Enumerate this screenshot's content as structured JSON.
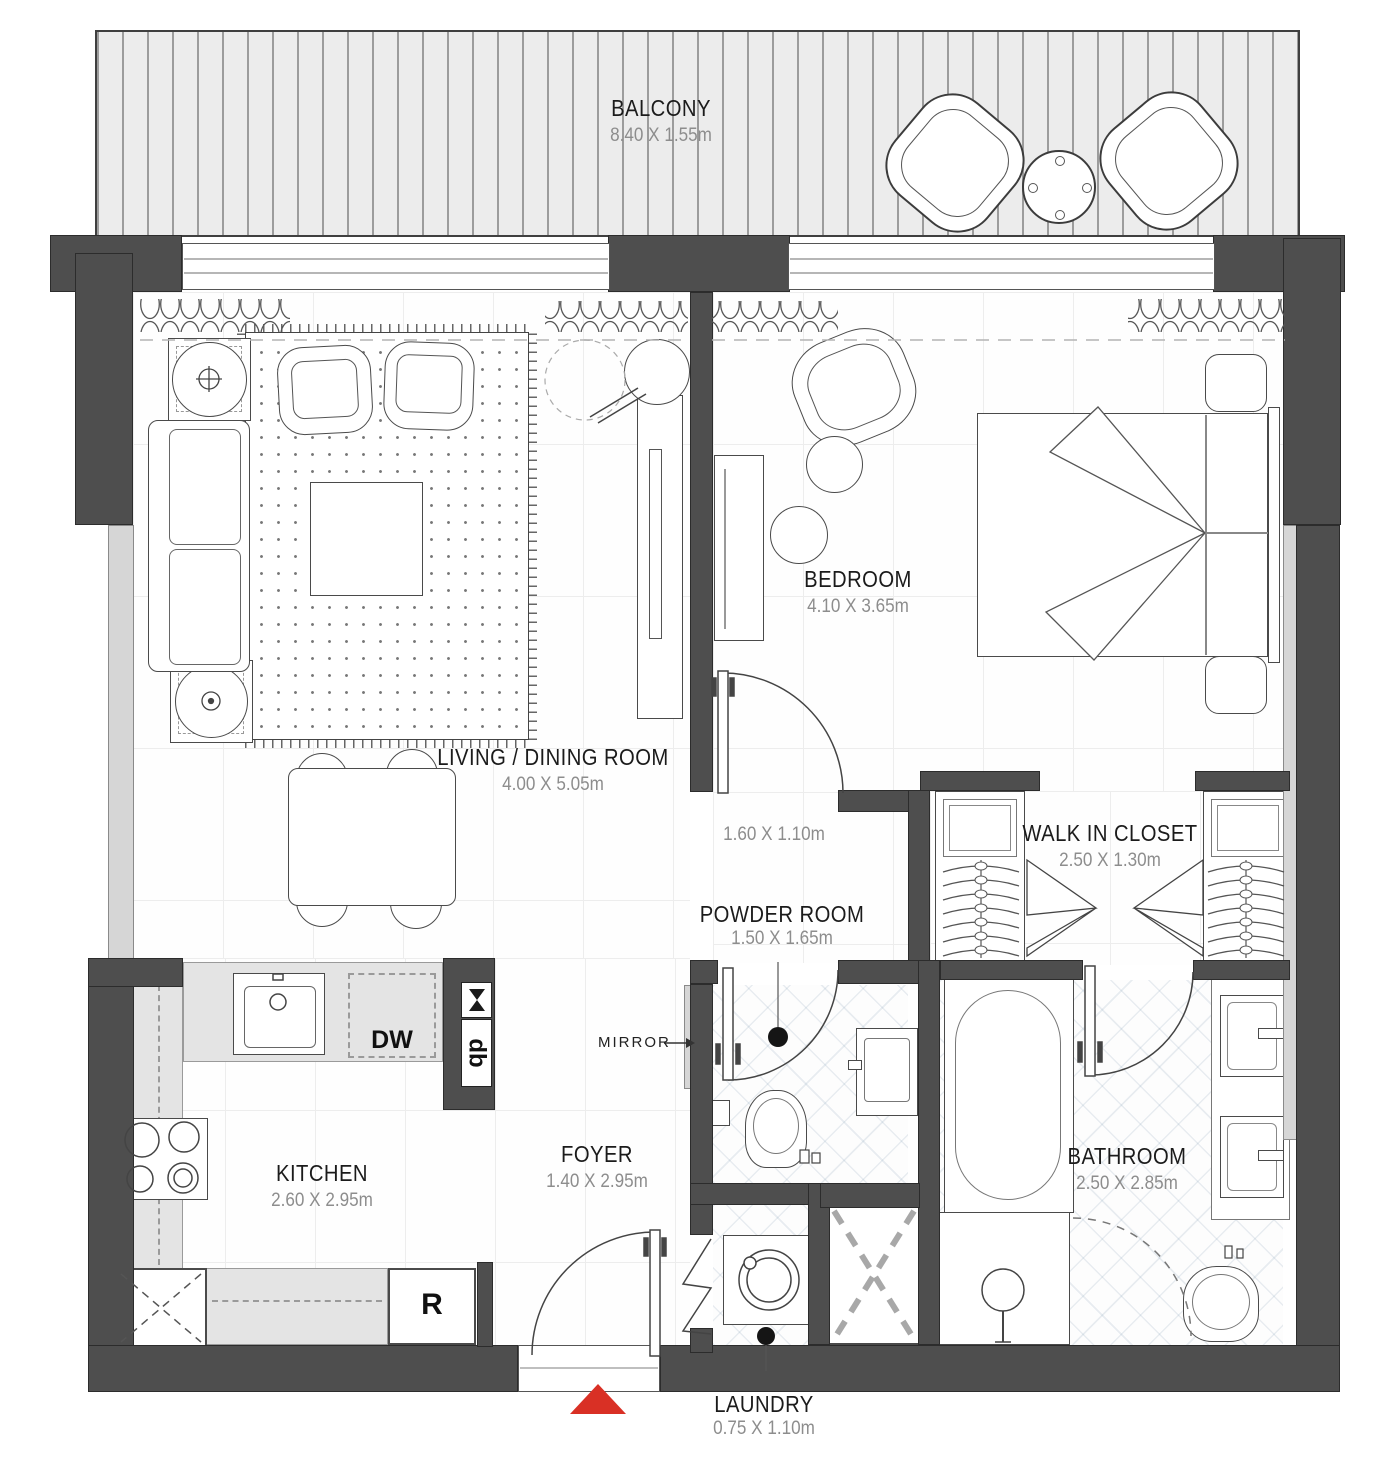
{
  "colors": {
    "wall": "#4e4e4e",
    "entrance_marker": "#d93025",
    "dim_text": "#8d8d8d",
    "label_text": "#1b1b1b"
  },
  "rooms": {
    "balcony": {
      "name": "BALCONY",
      "dims": "8.40 X 1.55m"
    },
    "bedroom": {
      "name": "BEDROOM",
      "dims": "4.10 X 3.65m"
    },
    "living": {
      "name": "LIVING / DINING ROOM",
      "dims": "4.00 X 5.05m"
    },
    "walk_in_closet": {
      "name": "WALK IN CLOSET",
      "dims": "2.50 X 1.30m"
    },
    "powder_room": {
      "name": "POWDER ROOM",
      "dims": "1.50 X 1.65m"
    },
    "kitchen": {
      "name": "KITCHEN",
      "dims": "2.60 X 2.95m"
    },
    "foyer": {
      "name": "FOYER",
      "dims": "1.40 X 2.95m"
    },
    "bathroom": {
      "name": "BATHROOM",
      "dims": "2.50 X 2.85m"
    },
    "laundry": {
      "name": "LAUNDRY",
      "dims": "0.75 X 1.10m"
    }
  },
  "annotations": {
    "bedroom_door_dims": "1.60 X 1.10m",
    "mirror": "MIRROR"
  },
  "appliances": {
    "dishwasher": "DW",
    "refrigerator": "R",
    "distribution_board": "db"
  }
}
